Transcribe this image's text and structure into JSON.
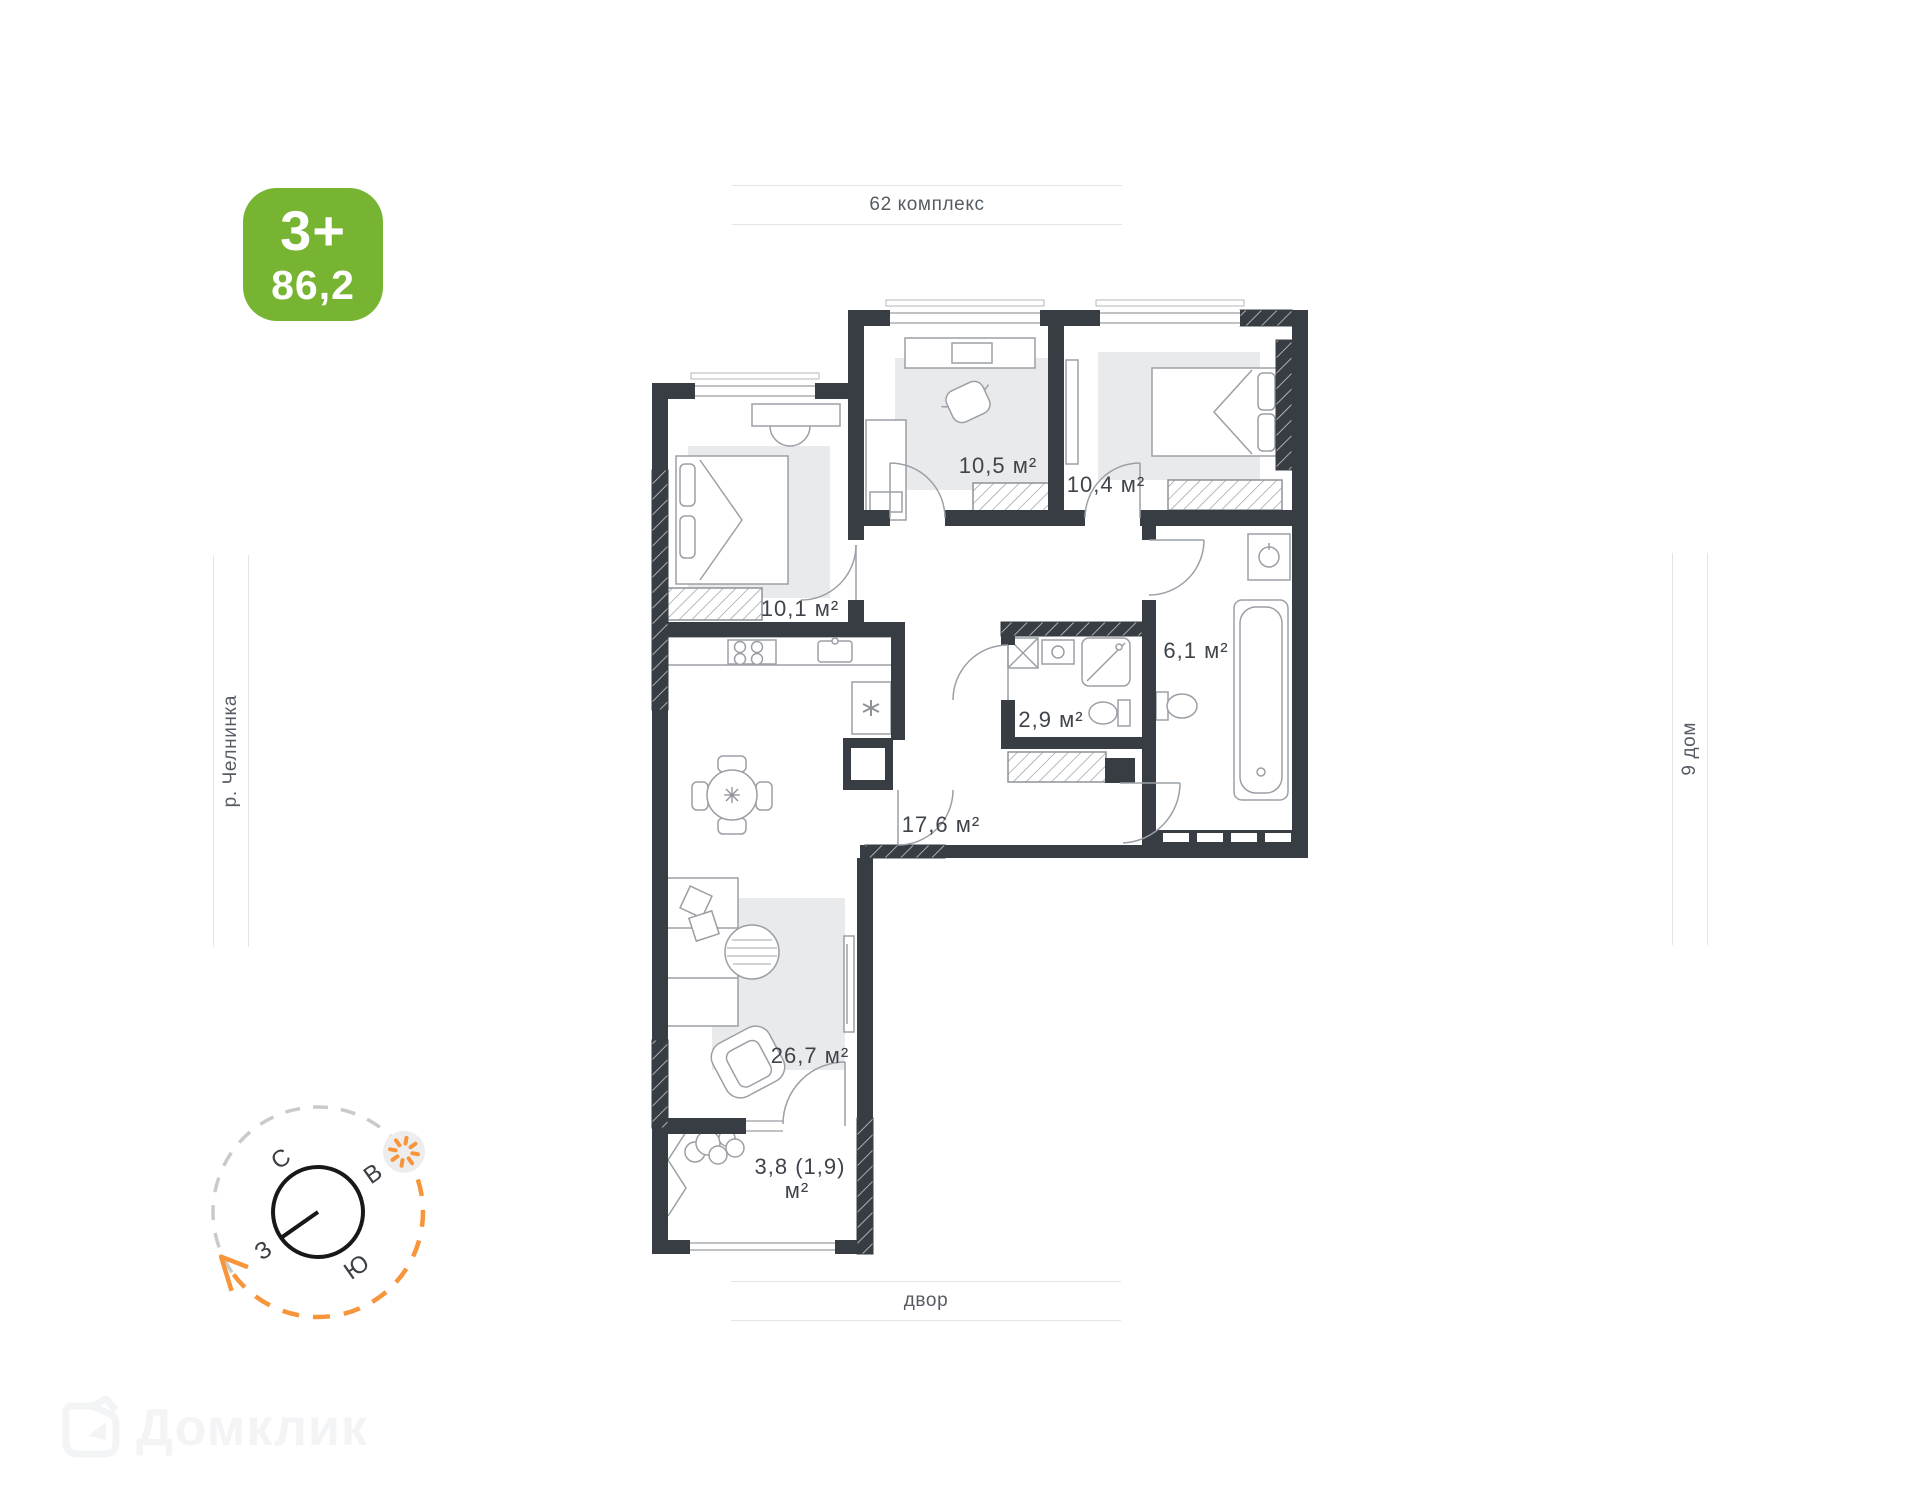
{
  "badge": {
    "rooms": "3+",
    "area": "86,2",
    "color": "#76b432"
  },
  "surroundings": {
    "top": "62 комплекс",
    "left": "р. Челнинка",
    "right": "9 дом",
    "bottom": "двор"
  },
  "rooms": [
    {
      "id": "bedroom-top-middle",
      "area_label": "10,5 м²"
    },
    {
      "id": "bedroom-top-right",
      "area_label": "10,4 м²"
    },
    {
      "id": "bedroom-left",
      "area_label": "10,1 м²"
    },
    {
      "id": "bathroom",
      "area_label": "6,1 м²"
    },
    {
      "id": "wc",
      "area_label": "2,9 м²"
    },
    {
      "id": "hallway",
      "area_label": "17,6 м²"
    },
    {
      "id": "kitchen-living",
      "area_label": "26,7 м²"
    },
    {
      "id": "balcony",
      "area_label": "3,8 (1,9)",
      "area_label_line2": "м²"
    }
  ],
  "compass": {
    "north": "С",
    "east": "В",
    "south": "Ю",
    "west": "З",
    "accent_color": "#f7953b"
  },
  "watermark": {
    "text": "Домклик"
  }
}
